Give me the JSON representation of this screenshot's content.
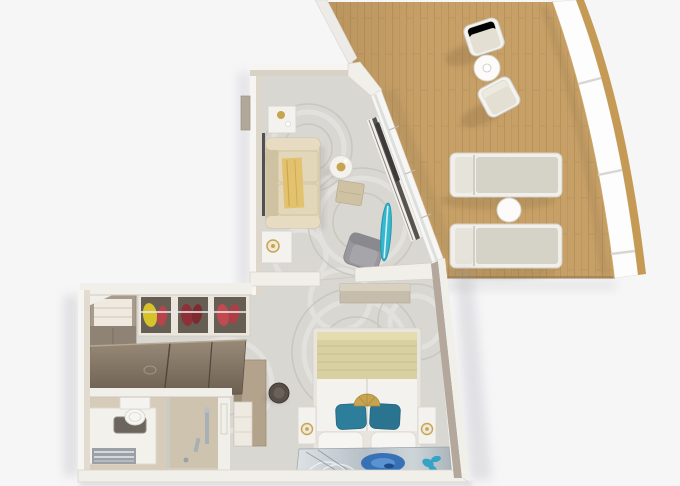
{
  "scene": {
    "type": "3d-floor-plan",
    "description": "Top-down 3D rendering of a ship suite floor plan with living room, bedroom, walk-in closet, bathroom and a curved teak balcony",
    "text_labels": []
  },
  "rooms": {
    "balcony": {
      "name": "balcony",
      "floor": "teak-deck",
      "railing": "curved-white-panel-railing-gold-trim",
      "furniture": [
        "outdoor-armchair",
        "outdoor-armchair",
        "round-bistro-table",
        "sun-lounger",
        "sun-lounger",
        "round-side-table"
      ]
    },
    "living_room": {
      "name": "living-room",
      "floor": "gray-swirl-carpet",
      "furniture": [
        "three-seat-sofa",
        "gold-throw-blanket",
        "side-table-with-candle",
        "side-table-with-lamp",
        "wall-panel-tv",
        "round-coffee-table",
        "ottoman",
        "lounge-armchair",
        "surfboard-art",
        "media-console",
        "glass-sliding-doors",
        "entry-door"
      ]
    },
    "bedroom": {
      "name": "bedroom",
      "floor": "gray-swirl-carpet",
      "furniture": [
        "double-bed",
        "khaki-bed-runner",
        "teal-pillows",
        "gold-pendant-lamp",
        "nightstand-with-lamp",
        "nightstand-with-lamp",
        "headboard-artwork",
        "dresser",
        "vanity-desk",
        "stool"
      ]
    },
    "closet": {
      "name": "walk-in-closet",
      "furniture": [
        "corner-shelf-unit",
        "wardrobe-bay-yellow-clothes",
        "wardrobe-bay-maroon-clothes",
        "wardrobe-bay-red-clothes",
        "chrome-hanging-rail",
        "dark-wood-cabinet-tops"
      ]
    },
    "bathroom": {
      "name": "bathroom",
      "floor": "beige-tile",
      "furniture": [
        "vanity-counter",
        "sink-basin",
        "faucet",
        "towel-shelf",
        "toilet",
        "glass-shower-partition",
        "shower-fixtures",
        "door-wall"
      ]
    }
  },
  "colors": {
    "bg": "#f6f6f7",
    "deck": "#c7a067",
    "deck_line": "#a98450",
    "gold_trim": "#c49a55",
    "rail": "#fdfdfd",
    "wall": "#f1efe9",
    "wall_hi": "#f7f5f1",
    "wall_face": "#d8d1c5",
    "taupe": "#b3a89b",
    "carpet": "#d9d7d2",
    "carpet_hi": "#ececea",
    "carpet_lo": "#bdbab3",
    "sofa": "#e0d4b6",
    "sofa_dk": "#cfc2a2",
    "throw_gold": "#e2c26e",
    "white_furn": "#f4f2ee",
    "gold": "#c7a44f",
    "chair_gray": "#98979b",
    "ottoman": "#cec2a3",
    "board_teal": "#35b7cd",
    "bed_khaki": "#d9d0a2",
    "bed_linen": "#f3f2ee",
    "pillow_teal": "#2d7e9a",
    "art_blue": "#2f6db5",
    "art_teal": "#35a3c6",
    "closet_wood": "#a89c8c",
    "box_dark": "#675e53",
    "clothes_yellow": "#d6c32c",
    "clothes_red": "#c2494f",
    "clothes_maroon": "#8e3037",
    "cab_hi": "#998a78",
    "cab_lo": "#6a5d4e",
    "desk_wood": "#b3a28c",
    "bath_floor": "#d7ccb9",
    "lounger_cushion": "#d5d2c8",
    "chair_cushion": "#e3dfd2"
  }
}
